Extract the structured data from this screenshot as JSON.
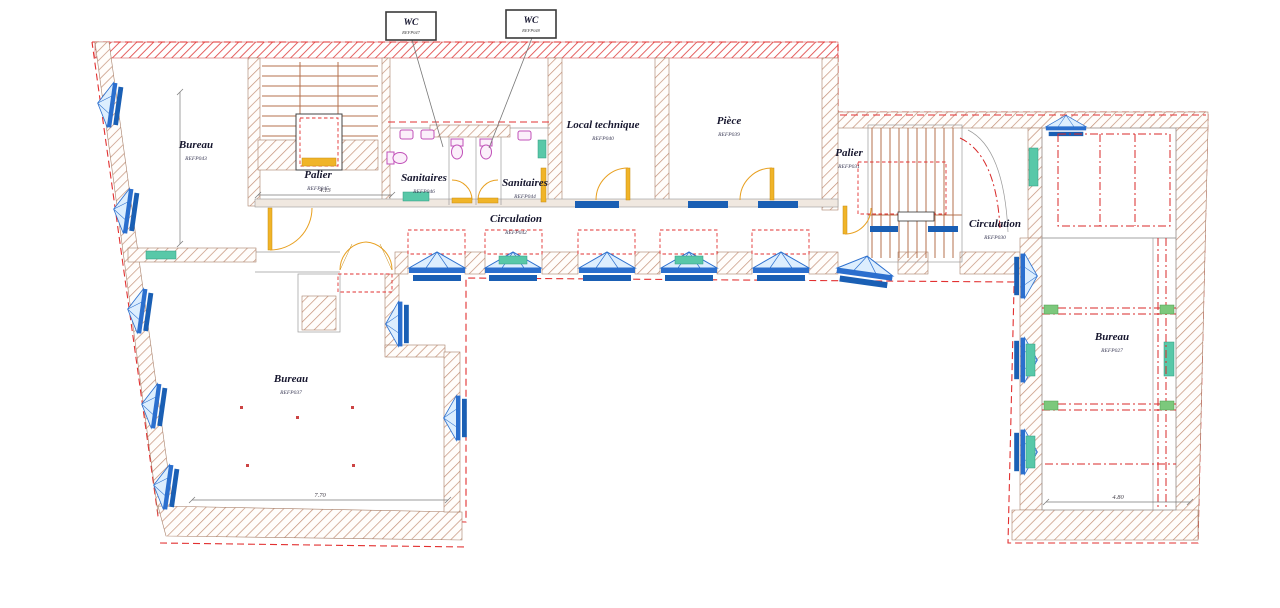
{
  "rooms": {
    "bureau_top_left": {
      "label": "Bureau",
      "code": "REFP043"
    },
    "palier_left": {
      "label": "Palier",
      "code": "REFP045"
    },
    "sanitaires_left": {
      "label": "Sanitaires",
      "code": "REFP046"
    },
    "sanitaires_right": {
      "label": "Sanitaires",
      "code": "REFP044"
    },
    "circulation_main": {
      "label": "Circulation",
      "code": "REFP042"
    },
    "local_technique": {
      "label": "Local technique",
      "code": "REFP040"
    },
    "piece": {
      "label": "Pièce",
      "code": "REFP039"
    },
    "palier_right": {
      "label": "Palier",
      "code": "REFP031"
    },
    "circulation_right": {
      "label": "Circulation",
      "code": "REFP030"
    },
    "bureau_right": {
      "label": "Bureau",
      "code": "REFP027"
    },
    "bureau_bottom": {
      "label": "Bureau",
      "code": "REFP037"
    }
  },
  "wc_tags": [
    {
      "label": "WC",
      "code": "REFP047"
    },
    {
      "label": "WC",
      "code": "REFP048"
    }
  ],
  "dimensions": {
    "corridor": "4.13",
    "bureau_bottom_width": "7.70",
    "bureau_right_width": "4.80"
  },
  "colors": {
    "wall_hatch": "#c49178",
    "boundary_red": "#e23030",
    "window_blue": "#2b6fce",
    "door_yellow": "#f0b428",
    "fixture_pink": "#c050b8",
    "radiator_teal": "#58c8a8",
    "stair_brown": "#b4714e"
  }
}
